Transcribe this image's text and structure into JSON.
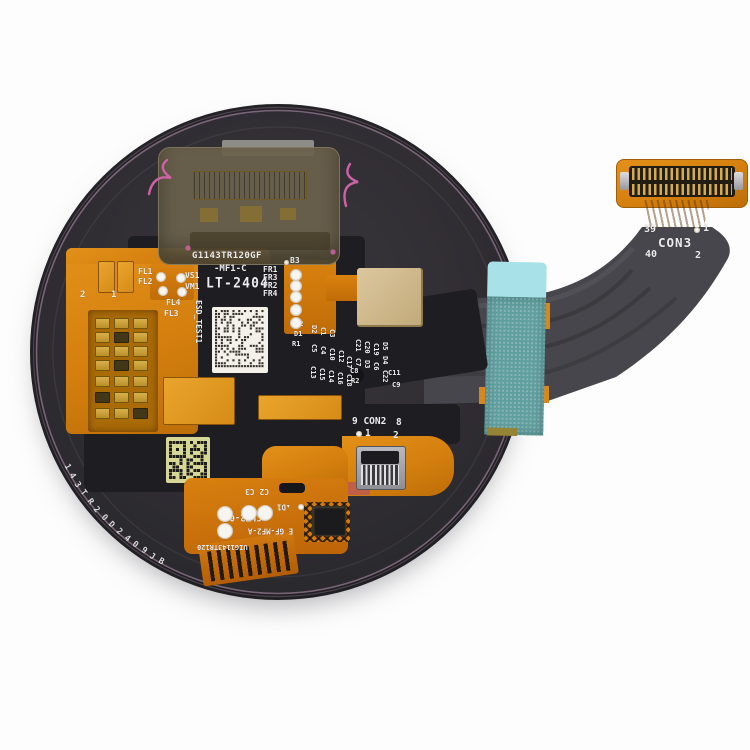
{
  "image_type": "product-photo",
  "subject": "Smartwatch round LCD display assembly with flex cable, rear view",
  "colors": {
    "background": "#fdfdfd",
    "cover_gray": "#2f2e33",
    "pcb_black": "#1e1d22",
    "flex_orange": "#d9820f",
    "gold_pad": "#e2a237",
    "beige_pad": "#d2bd94",
    "cable_gray": "#47464c",
    "tape_teal": "#619e9e",
    "tape_cyan": "#a8e2e8",
    "wire_pink": "#cf62a6",
    "rim_pink": "#cfa6c8",
    "qr_background": "#d6d695",
    "text_white": "#ededee"
  },
  "board": {
    "edge_marking": "143TR20D2409JB",
    "model_code": "G1143TR120GF",
    "variant_code": "-MF1-C",
    "date_code": "LT-2404",
    "esd_label": "ESD_TEST1",
    "connectors": [
      {
        "name": "CON2",
        "pins": [
          "9",
          "8",
          "1",
          "2"
        ]
      },
      {
        "name": "CON3",
        "pins": [
          "39",
          "1",
          "40",
          "2"
        ]
      }
    ],
    "bottom_flex_markings": [
      "C2 C3",
      "D1",
      "CLT2-09",
      "E GF-MF2-A",
      "UIG1143TR120"
    ],
    "labels": [
      {
        "t": "G1143TR120GF",
        "x": 192,
        "y": 252,
        "r": 0,
        "s": 9,
        "w": 700,
        "sp": 0.4
      },
      {
        "t": "-MF1-C",
        "x": 214,
        "y": 265,
        "r": 0,
        "s": 9,
        "w": 700
      },
      {
        "t": "LT-2404",
        "x": 206,
        "y": 277,
        "r": 0,
        "s": 13,
        "w": 700,
        "cls": "seg"
      },
      {
        "t": "B3",
        "x": 290,
        "y": 257,
        "r": 0,
        "s": 8
      },
      {
        "t": "FL1",
        "x": 138,
        "y": 268,
        "r": 0,
        "s": 8
      },
      {
        "t": "FL2",
        "x": 138,
        "y": 278,
        "r": 0,
        "s": 8
      },
      {
        "t": "VS1",
        "x": 185,
        "y": 272,
        "r": 0,
        "s": 8
      },
      {
        "t": "VM1",
        "x": 185,
        "y": 283,
        "r": 0,
        "s": 8
      },
      {
        "t": "FL4",
        "x": 166,
        "y": 299,
        "r": 0,
        "s": 8
      },
      {
        "t": "FL3",
        "x": 164,
        "y": 310,
        "r": 0,
        "s": 8
      },
      {
        "t": "FR1",
        "x": 263,
        "y": 266,
        "r": 0,
        "s": 8
      },
      {
        "t": "FR3",
        "x": 263,
        "y": 274,
        "r": 0,
        "s": 8
      },
      {
        "t": "FR2",
        "x": 263,
        "y": 282,
        "r": 0,
        "s": 8
      },
      {
        "t": "FR4",
        "x": 263,
        "y": 290,
        "r": 0,
        "s": 8
      },
      {
        "t": "2",
        "x": 80,
        "y": 291,
        "r": 0,
        "s": 9
      },
      {
        "t": "1",
        "x": 111,
        "y": 291,
        "r": 0,
        "s": 9
      },
      {
        "t": "ESD_TEST1",
        "x": 192,
        "y": 300,
        "r": 90,
        "s": 8,
        "w": 700
      },
      {
        "t": "C2",
        "x": 295,
        "y": 321,
        "r": 0,
        "s": 7
      },
      {
        "t": "D1",
        "x": 294,
        "y": 331,
        "r": 0,
        "s": 7
      },
      {
        "t": "R1",
        "x": 292,
        "y": 341,
        "r": 0,
        "s": 7
      },
      {
        "t": "D2",
        "x": 308,
        "y": 325,
        "r": 90,
        "s": 7
      },
      {
        "t": "C1",
        "x": 317,
        "y": 327,
        "r": 90,
        "s": 7
      },
      {
        "t": "C3",
        "x": 326,
        "y": 329,
        "r": 90,
        "s": 7
      },
      {
        "t": "C5",
        "x": 308,
        "y": 344,
        "r": 90,
        "s": 7
      },
      {
        "t": "C4",
        "x": 317,
        "y": 346,
        "r": 90,
        "s": 7
      },
      {
        "t": "C10",
        "x": 326,
        "y": 348,
        "r": 90,
        "s": 7
      },
      {
        "t": "C12",
        "x": 335,
        "y": 350,
        "r": 90,
        "s": 7
      },
      {
        "t": "C13",
        "x": 307,
        "y": 366,
        "r": 90,
        "s": 7
      },
      {
        "t": "C15",
        "x": 316,
        "y": 368,
        "r": 90,
        "s": 7
      },
      {
        "t": "C14",
        "x": 325,
        "y": 370,
        "r": 90,
        "s": 7
      },
      {
        "t": "C16",
        "x": 334,
        "y": 372,
        "r": 90,
        "s": 7
      },
      {
        "t": "C17",
        "x": 343,
        "y": 356,
        "r": 90,
        "s": 7
      },
      {
        "t": "C18",
        "x": 343,
        "y": 374,
        "r": 90,
        "s": 7
      },
      {
        "t": "C8",
        "x": 350,
        "y": 368,
        "r": 0,
        "s": 7
      },
      {
        "t": "R2",
        "x": 351,
        "y": 378,
        "r": 0,
        "s": 7
      },
      {
        "t": "C21",
        "x": 352,
        "y": 339,
        "r": 90,
        "s": 7
      },
      {
        "t": "C7",
        "x": 352,
        "y": 358,
        "r": 90,
        "s": 7
      },
      {
        "t": "C20",
        "x": 361,
        "y": 341,
        "r": 90,
        "s": 7
      },
      {
        "t": "D3",
        "x": 361,
        "y": 360,
        "r": 90,
        "s": 7
      },
      {
        "t": "C19",
        "x": 370,
        "y": 343,
        "r": 90,
        "s": 7
      },
      {
        "t": "C6",
        "x": 370,
        "y": 362,
        "r": 90,
        "s": 7
      },
      {
        "t": "D5",
        "x": 379,
        "y": 342,
        "r": 90,
        "s": 7
      },
      {
        "t": "D4",
        "x": 379,
        "y": 356,
        "r": 90,
        "s": 7
      },
      {
        "t": "C22",
        "x": 379,
        "y": 370,
        "r": 90,
        "s": 7
      },
      {
        "t": "C11",
        "x": 388,
        "y": 370,
        "r": 0,
        "s": 7
      },
      {
        "t": "C9",
        "x": 392,
        "y": 382,
        "r": 0,
        "s": 7
      },
      {
        "t": "9 CON2",
        "x": 352,
        "y": 417,
        "r": 0,
        "s": 9.5,
        "w": 700
      },
      {
        "t": "8",
        "x": 396,
        "y": 418,
        "r": 0,
        "s": 9.5,
        "w": 700
      },
      {
        "t": "1",
        "x": 365,
        "y": 429,
        "r": 0,
        "s": 9.5,
        "w": 700
      },
      {
        "t": "2",
        "x": 393,
        "y": 431,
        "r": 0,
        "s": 9.5,
        "w": 700
      },
      {
        "t": "C2 C3",
        "x": 245,
        "y": 487,
        "r": 180,
        "s": 8
      },
      {
        "t": "▴D1",
        "x": 277,
        "y": 503,
        "r": 180,
        "s": 7.5
      },
      {
        "t": "CLT2-09",
        "x": 224,
        "y": 512,
        "r": 180,
        "s": 9,
        "w": 700
      },
      {
        "t": "E GF-MF2-A",
        "x": 248,
        "y": 527,
        "r": 180,
        "s": 7.5
      },
      {
        "t": "UIG1143TR120",
        "x": 197,
        "y": 543,
        "r": 180,
        "s": 7
      },
      {
        "t": "39",
        "x": 644,
        "y": 225,
        "r": 0,
        "s": 10,
        "w": 700
      },
      {
        "t": "1",
        "x": 703,
        "y": 224,
        "r": 0,
        "s": 10,
        "w": 700
      },
      {
        "t": "CON3",
        "x": 658,
        "y": 237,
        "r": 0,
        "s": 12.5,
        "w": 700,
        "sp": 1
      },
      {
        "t": "40",
        "x": 645,
        "y": 250,
        "r": 0,
        "s": 10,
        "w": 700
      },
      {
        "t": "2",
        "x": 695,
        "y": 251,
        "r": 0,
        "s": 10,
        "w": 700
      }
    ]
  }
}
